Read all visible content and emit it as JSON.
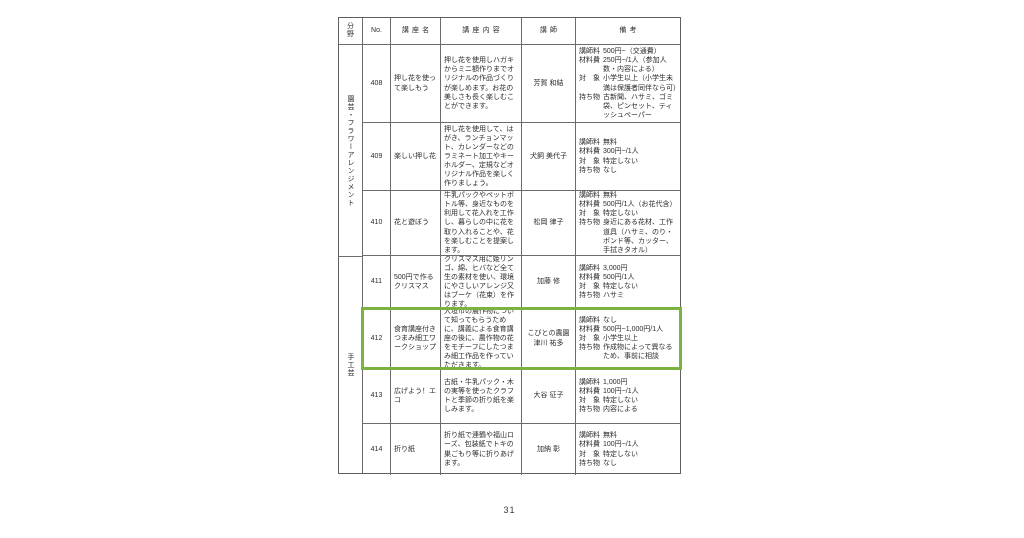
{
  "document": {
    "page_number": "31",
    "highlight_color": "#7ab43e"
  },
  "table": {
    "headers": {
      "field": "分野",
      "no": "No.",
      "name": "講座名",
      "content": "講座内容",
      "instructor": "講師",
      "remarks": "備考"
    },
    "field_groups": [
      {
        "label": "園芸・フラワーアレンジメント"
      },
      {
        "label": "手工芸"
      }
    ],
    "rows": [
      {
        "no": "408",
        "name": "押し花を使って楽しもう",
        "content": "押し花を使用しハガキからミニ額作りまでオリジナルの作品づくりが楽しめます。お花の美しさも長く楽しむことができます。",
        "instructor": "芳賀 和結",
        "remarks": [
          {
            "label": "講師料",
            "value": "500円~（交通費）"
          },
          {
            "label": "材料費",
            "value": "250円~/1人（参加人数・内容による）"
          },
          {
            "label": "対　象",
            "value": "小学生以上（小学生未満は保護者同伴なら可）"
          },
          {
            "label": "持ち物",
            "value": "古新聞、ハサミ、ゴミ袋、ピンセット、ティッシュペーパー"
          }
        ]
      },
      {
        "no": "409",
        "name": "楽しい押し花",
        "content": "押し花を使用して、はがき、ランチョンマット、カレンダーなどのラミネート加工やキーホルダー、定規などオリジナル作品を楽しく作りましょう。",
        "instructor": "犬飼 美代子",
        "remarks": [
          {
            "label": "講師料",
            "value": "無料"
          },
          {
            "label": "材料費",
            "value": "300円~/1人"
          },
          {
            "label": "対　象",
            "value": "特定しない"
          },
          {
            "label": "持ち物",
            "value": "なし"
          }
        ]
      },
      {
        "no": "410",
        "name": "花と遊ぼう",
        "content": "牛乳パックやペットボトル等、身近なものを利用して花入れを工作し、暮らしの中に花を取り入れることや、花を楽しむことを提案します。",
        "instructor": "松岡 律子",
        "remarks": [
          {
            "label": "講師料",
            "value": "無料"
          },
          {
            "label": "材料費",
            "value": "500円/1人（お花代含）"
          },
          {
            "label": "対　象",
            "value": "特定しない"
          },
          {
            "label": "持ち物",
            "value": "身近にある花材、工作道具（ハサミ、のり・ボンド等、カッター、手拭きタオル）"
          }
        ]
      },
      {
        "no": "411",
        "name": "500円で作るクリスマス",
        "content": "クリスマス用に姫リンゴ、綿、ヒバなど全て生の素材を使い、環境にやさしいアレンジ又はブーケ（花束）を作ります。",
        "instructor": "加藤 修",
        "remarks": [
          {
            "label": "講師料",
            "value": "3,000円"
          },
          {
            "label": "材料費",
            "value": "500円/1人"
          },
          {
            "label": "対　象",
            "value": "特定しない"
          },
          {
            "label": "持ち物",
            "value": "ハサミ"
          }
        ]
      },
      {
        "no": "412",
        "name": "食育講座付きつまみ細工ワークショップ",
        "content": "大垣市の農作物について知ってもらうために、講義による食育講座の後に、農作物の花をモチーフにしたつまみ細工作品を作っていただきます。",
        "instructor": "こびとの農園\n津川 祐多",
        "highlighted": true,
        "remarks": [
          {
            "label": "講師料",
            "value": "なし"
          },
          {
            "label": "材料費",
            "value": "500円~1,000円/1人"
          },
          {
            "label": "対　象",
            "value": "小学生以上"
          },
          {
            "label": "持ち物",
            "value": "作成物によって異なるため、事前に相談"
          }
        ]
      },
      {
        "no": "413",
        "name": "広げよう！エコ",
        "content": "古紙・牛乳パック・木の実等を使ったクラフトと季節の折り紙を楽しみます。",
        "instructor": "大谷 征子",
        "remarks": [
          {
            "label": "講師料",
            "value": "1,000円"
          },
          {
            "label": "材料費",
            "value": "100円~/1人"
          },
          {
            "label": "対　象",
            "value": "特定しない"
          },
          {
            "label": "持ち物",
            "value": "内容による"
          }
        ]
      },
      {
        "no": "414",
        "name": "折り紙",
        "content": "折り紙で連鶴や福山ローズ、包装紙でトキの巣ごもり等に折りあげます。",
        "instructor": "加納 彰",
        "remarks": [
          {
            "label": "講師料",
            "value": "無料"
          },
          {
            "label": "材料費",
            "value": "100円~/1人"
          },
          {
            "label": "対　象",
            "value": "特定しない"
          },
          {
            "label": "持ち物",
            "value": "なし"
          }
        ]
      }
    ]
  }
}
